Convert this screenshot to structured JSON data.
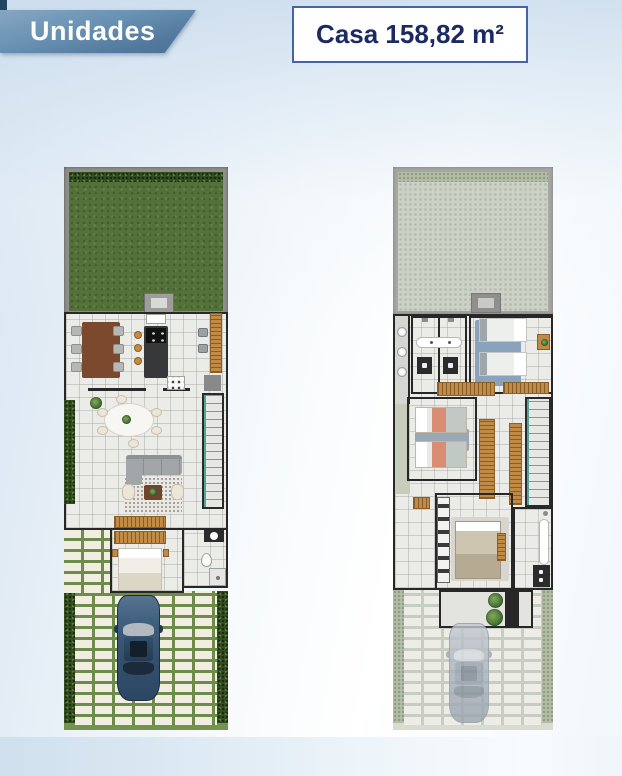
{
  "header": {
    "section_title": "Unidades",
    "unit_area_label": "Casa 158,82 m²"
  },
  "colors": {
    "accent_navy": "#1b2a63",
    "ribbon_blue": "#5c84a6",
    "box_border": "#4763a8",
    "background_tint": "#d8e5f1",
    "grass_green": "#55713b",
    "car_blue": "#40607f"
  }
}
